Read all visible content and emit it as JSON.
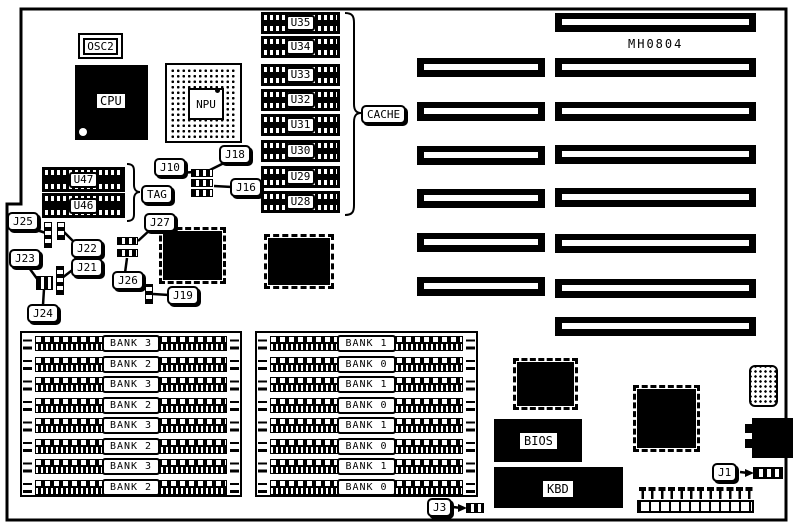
{
  "diagram": {
    "model_number": "MH0804",
    "oscillator": "OSC2",
    "cpu": "CPU",
    "npu": "NPU",
    "cache_label": "CACHE",
    "cache_chips": [
      "U35",
      "U34",
      "U33",
      "U32",
      "U31",
      "U30",
      "U29",
      "U28"
    ],
    "tag_label": "TAG",
    "tag_chips": [
      "U47",
      "U46"
    ],
    "bios": "BIOS",
    "keyboard": "KBD",
    "jumpers": {
      "j10": "J10",
      "j18": "J18",
      "j16": "J16",
      "j27": "J27",
      "j25": "J25",
      "j22": "J22",
      "j23": "J23",
      "j21": "J21",
      "j26": "J26",
      "j24": "J24",
      "j19": "J19",
      "j3": "J3",
      "j1": "J1"
    },
    "memory_banks": {
      "left": [
        "BANK 3",
        "BANK 2",
        "BANK 3",
        "BANK 2",
        "BANK 3",
        "BANK 2",
        "BANK 3",
        "BANK 2"
      ],
      "right": [
        "BANK 1",
        "BANK 0",
        "BANK 1",
        "BANK 0",
        "BANK 1",
        "BANK 0",
        "BANK 1",
        "BANK 0"
      ]
    },
    "colors": {
      "ink": "#000000",
      "paper": "#ffffff"
    }
  }
}
